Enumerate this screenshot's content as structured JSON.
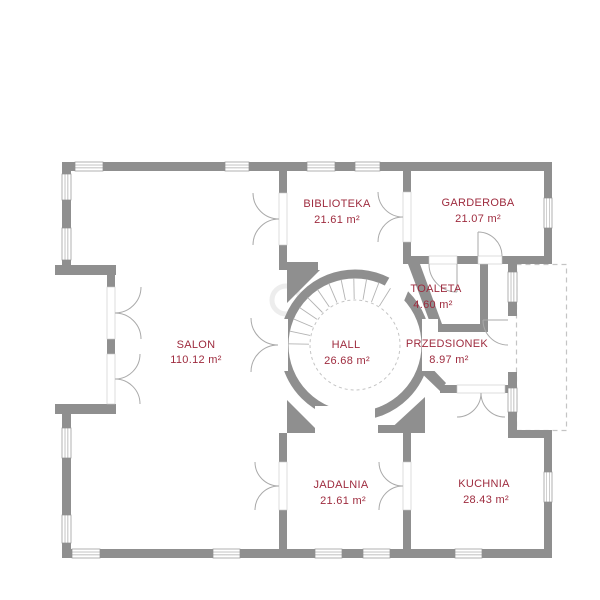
{
  "plan": {
    "rooms": [
      {
        "id": "salon",
        "name": "SALON",
        "area": "110.12 m²"
      },
      {
        "id": "biblioteka",
        "name": "BIBLIOTEKA",
        "area": "21.61 m²"
      },
      {
        "id": "garderoba",
        "name": "GARDEROBA",
        "area": "21.07 m²"
      },
      {
        "id": "toaleta",
        "name": "TOALETA",
        "area": "4.60 m²"
      },
      {
        "id": "hall",
        "name": "HALL",
        "area": "26.68 m²"
      },
      {
        "id": "przedsionek",
        "name": "PRZEDSIONEK",
        "area": "8.97 m²"
      },
      {
        "id": "jadalnia",
        "name": "JADALNIA",
        "area": "21.61 m²"
      },
      {
        "id": "kuchnia",
        "name": "KUCHNIA",
        "area": "28.43 m²"
      }
    ],
    "colors": {
      "wall": "#8f8f8f",
      "label": "#9e2b3e",
      "line": "#a9a9a9",
      "dash": "#c4c4c4",
      "watermark": "#ededed"
    }
  }
}
